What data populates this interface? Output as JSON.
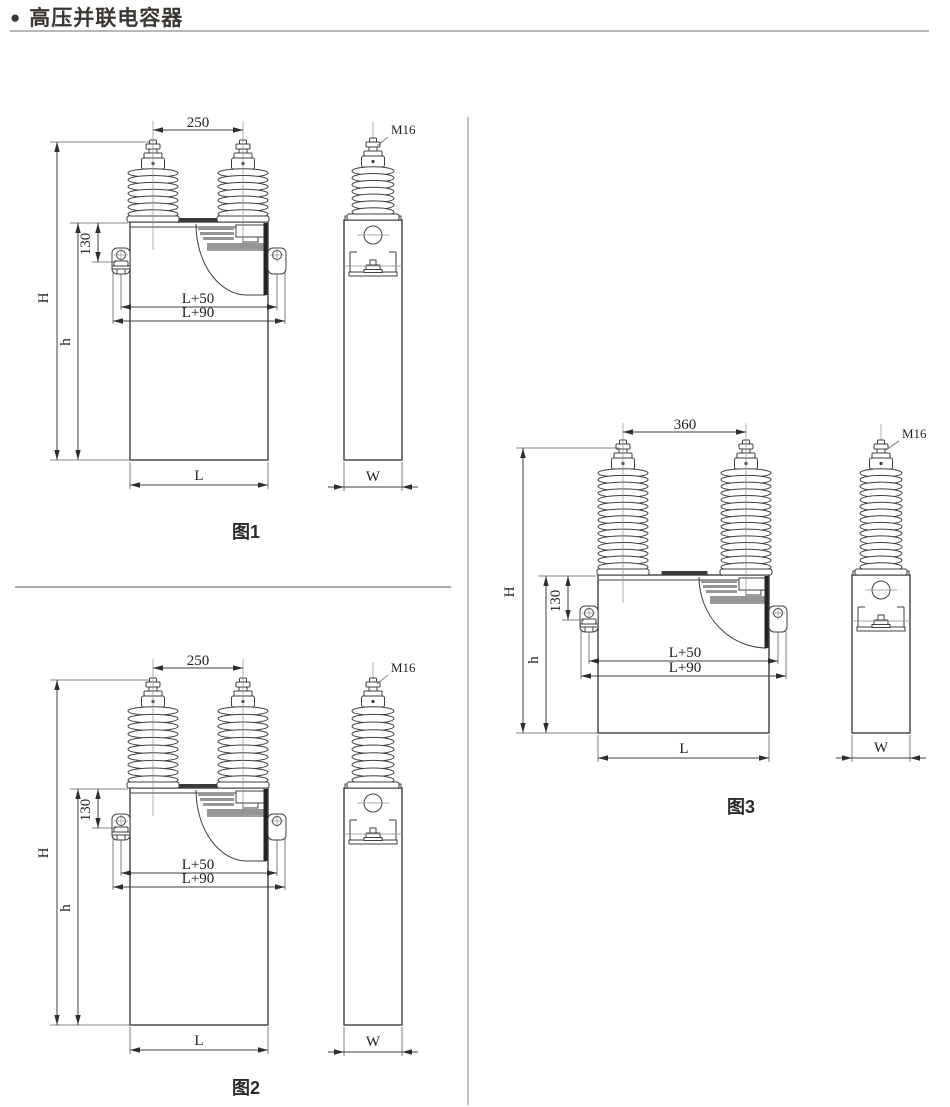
{
  "header": {
    "bullet": "●",
    "title": "高压并联电容器"
  },
  "figures": [
    {
      "caption": "图1",
      "labels": {
        "span": "250",
        "m16": "M16",
        "d130": "130",
        "H": "H",
        "h": "h",
        "l50": "L+50",
        "l90": "L+90",
        "L": "L",
        "W": "W"
      }
    },
    {
      "caption": "图2",
      "labels": {
        "span": "250",
        "m16": "M16",
        "d130": "130",
        "H": "H",
        "h": "h",
        "l50": "L+50",
        "l90": "L+90",
        "L": "L",
        "W": "W"
      }
    },
    {
      "caption": "图3",
      "labels": {
        "span": "360",
        "m16": "M16",
        "d130": "130",
        "H": "H",
        "h": "h",
        "l50": "L+50",
        "l90": "L+90",
        "L": "L",
        "W": "W"
      }
    }
  ]
}
